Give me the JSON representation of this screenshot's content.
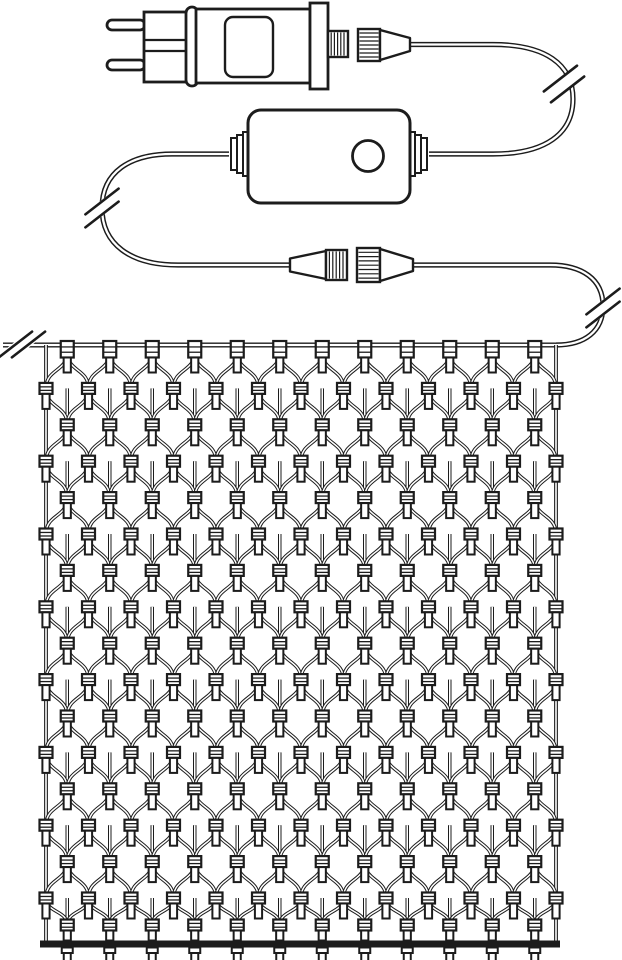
{
  "canvas": {
    "width": 622,
    "height": 960,
    "background": "#ffffff",
    "line_color": "#1c1c1c"
  },
  "diagram": {
    "kind": "product-line-drawing",
    "subject": "net-lights-with-plug-adapter-and-controller",
    "components": [
      {
        "id": "eu-plug",
        "icon": "two-pin-plug-icon"
      },
      {
        "id": "power-adapter",
        "icon": "adapter-box-icon"
      },
      {
        "id": "adapter-screw-connector",
        "icon": "threaded-connector-icon"
      },
      {
        "id": "adapter-coupling-nut",
        "icon": "coupling-nut-icon"
      },
      {
        "id": "controller-box",
        "icon": "controller-icon"
      },
      {
        "id": "controller-button",
        "icon": "round-button-icon"
      },
      {
        "id": "inline-screw-connector",
        "icon": "threaded-connector-icon"
      },
      {
        "id": "inline-coupling-nut",
        "icon": "coupling-nut-icon"
      },
      {
        "id": "cable-break-marks",
        "icon": "double-slash-break-icon",
        "count": 4
      },
      {
        "id": "light-net",
        "icon": "net-of-lights-icon"
      }
    ]
  },
  "net_structure": {
    "left": 46,
    "right": 556,
    "top_wire_y": 345,
    "bottom_bar_y": 944,
    "row0_y": 352,
    "row_spacing": 36.4,
    "col_spacing": 42.5,
    "field_rows": 16,
    "even_row_bulbs": 12,
    "odd_row_bulbs": 13,
    "bar_row_y": 925,
    "bottom_edge_bulbs": 12,
    "total_bulbs": 212
  },
  "geometry": {
    "plug": {
      "pin1": [
        107,
        20,
        38,
        10
      ],
      "pin2": [
        107,
        60,
        38,
        10
      ],
      "body": [
        144,
        12,
        46,
        70
      ],
      "band_y1": 40,
      "band_y2": 51,
      "collar": [
        186,
        7,
        12,
        79
      ]
    },
    "adapter": {
      "body": [
        196,
        9,
        114,
        74
      ],
      "label": [
        225,
        17,
        48,
        60
      ],
      "flange": [
        310,
        3,
        18,
        86
      ],
      "stub": [
        328,
        31,
        20,
        26
      ],
      "nut": [
        358,
        29,
        22,
        32
      ],
      "cone": [
        [
          380,
          30
        ],
        [
          410,
          38
        ],
        [
          410,
          51
        ],
        [
          380,
          60
        ]
      ]
    },
    "controller": {
      "body": [
        248,
        110,
        162,
        93
      ],
      "button": [
        368,
        156,
        15.5
      ],
      "wire_y": 154
    },
    "connector_b": {
      "center_y": 265,
      "male_cone": [
        [
          290,
          258.5
        ],
        [
          326,
          251
        ],
        [
          326,
          279
        ],
        [
          290,
          271.5
        ]
      ],
      "threaded": [
        326,
        250,
        21,
        30
      ],
      "nut": [
        357,
        248,
        23,
        34
      ],
      "out_cone": [
        [
          380,
          249
        ],
        [
          413,
          259
        ],
        [
          413,
          271
        ],
        [
          380,
          281
        ]
      ]
    },
    "cable_a": "M410,44.5 L493,44.5 C545,44.5 573,64 573,99 C573,134 545,154 493,154 L429,154",
    "cable_b": "M229,154 L172,154 C130,154 102,172 102,208 C102,244 130,265 178,265 L291,265",
    "cable_c": "M413,265 L550,265 C582,265 603,279 603,306 C603,331 585,345 556,345",
    "breaks": [
      {
        "cx": 564,
        "cy": 84,
        "ux": 0.55,
        "uy": 0.835
      },
      {
        "cx": 102,
        "cy": 208,
        "ux": 0,
        "uy": 1
      },
      {
        "cx": 603,
        "cy": 308,
        "ux": 0,
        "uy": 1
      },
      {
        "cx": 22,
        "cy": 344.5,
        "ux": 1,
        "uy": 0
      }
    ]
  }
}
